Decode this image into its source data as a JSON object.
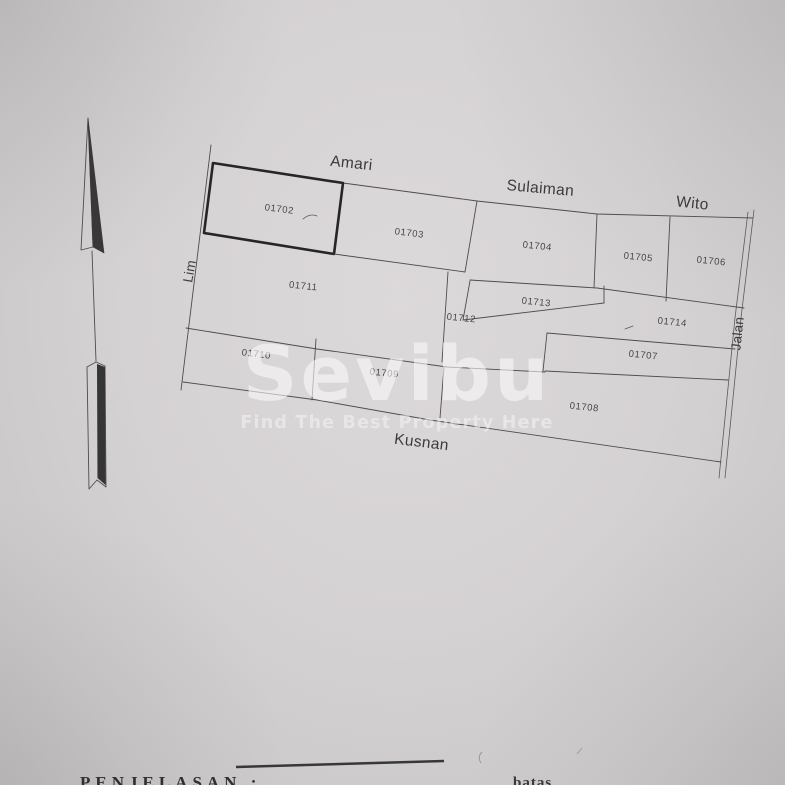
{
  "watermark": {
    "brand": "Sevibu",
    "tagline": "Find The Best Property Here"
  },
  "map": {
    "highlighted_parcel": "01702",
    "parcels": [
      {
        "id": "01702"
      },
      {
        "id": "01703"
      },
      {
        "id": "01704"
      },
      {
        "id": "01705"
      },
      {
        "id": "01706"
      },
      {
        "id": "01711"
      },
      {
        "id": "01712"
      },
      {
        "id": "01713"
      },
      {
        "id": "01714"
      },
      {
        "id": "01710"
      },
      {
        "id": "01709"
      },
      {
        "id": "01707"
      },
      {
        "id": "01708"
      }
    ],
    "adjacent_owners": [
      {
        "name": "Amari"
      },
      {
        "name": "Sulaiman"
      },
      {
        "name": "Wito"
      },
      {
        "name": "Kusnan"
      }
    ],
    "roads": [
      {
        "name": "Lim"
      },
      {
        "name": "Jalan"
      }
    ]
  },
  "footer": {
    "section_heading": "PENJELASAN :",
    "partial_right_text": "batas"
  },
  "colors": {
    "paper": "#d5d2d3",
    "ink": "#4a4a4a",
    "highlight_ink": "#262626",
    "watermark_white": "#faf9f9"
  }
}
